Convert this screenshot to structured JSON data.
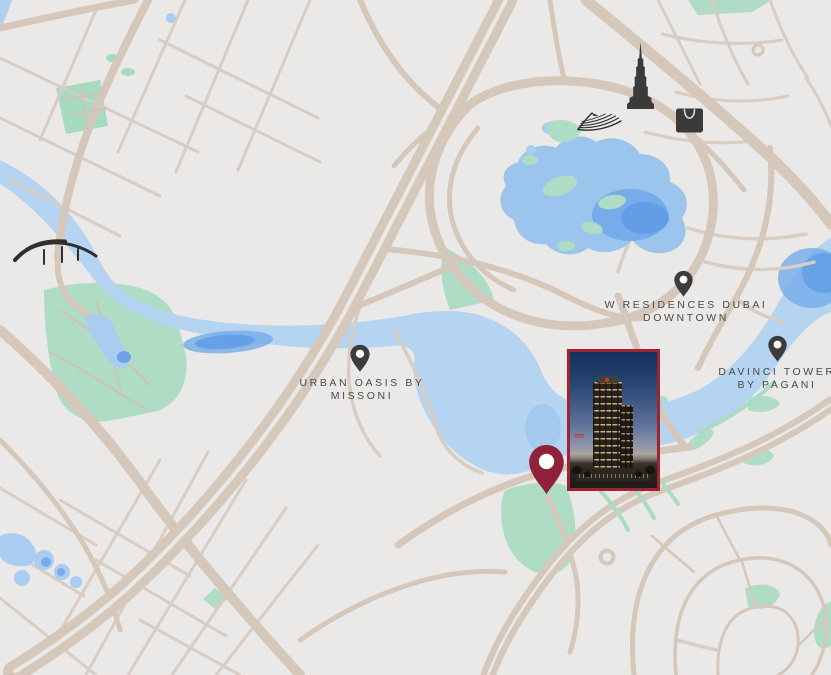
{
  "map": {
    "description": "stylized real-estate location map of Downtown Dubai area",
    "colors": {
      "background": "#eae9e7",
      "road": "#d5c8ba",
      "road_minor": "#d8cdc2",
      "water": "#b4d4f1",
      "water_deep": "#5f9ce4",
      "park_green": "#afdcc4",
      "icon_dark": "#3a3a38",
      "pin_dark": "#3d3c3c",
      "accent_maroon": "#8f2238",
      "label_text": "#4c4a46"
    },
    "landmarks": [
      {
        "icon": "burj-khalifa-tower-icon"
      },
      {
        "icon": "shopping-bag-icon"
      },
      {
        "icon": "dhow-sail-icon"
      },
      {
        "icon": "arch-bridge-icon"
      }
    ],
    "pois": [
      {
        "id": "w-residences-dubai-downtown",
        "pin": "map-pin-icon",
        "label_line1": "W RESIDENCES DUBAI",
        "label_line2": "DOWNTOWN"
      },
      {
        "id": "urban-oasis-by-missoni",
        "pin": "map-pin-icon",
        "label_line1": "URBAN OASIS BY",
        "label_line2": "MISSONI"
      },
      {
        "id": "davinci-tower-by-pagani",
        "pin": "map-pin-icon",
        "label_line1": "DAVINCI TOWER",
        "label_line2": "BY PAGANI"
      }
    ],
    "property": {
      "pin": "property-location-pin-icon",
      "pin_color": "#8f2238",
      "photo_border_color": "#9e2333",
      "photo": "tower-render-at-dusk"
    }
  }
}
